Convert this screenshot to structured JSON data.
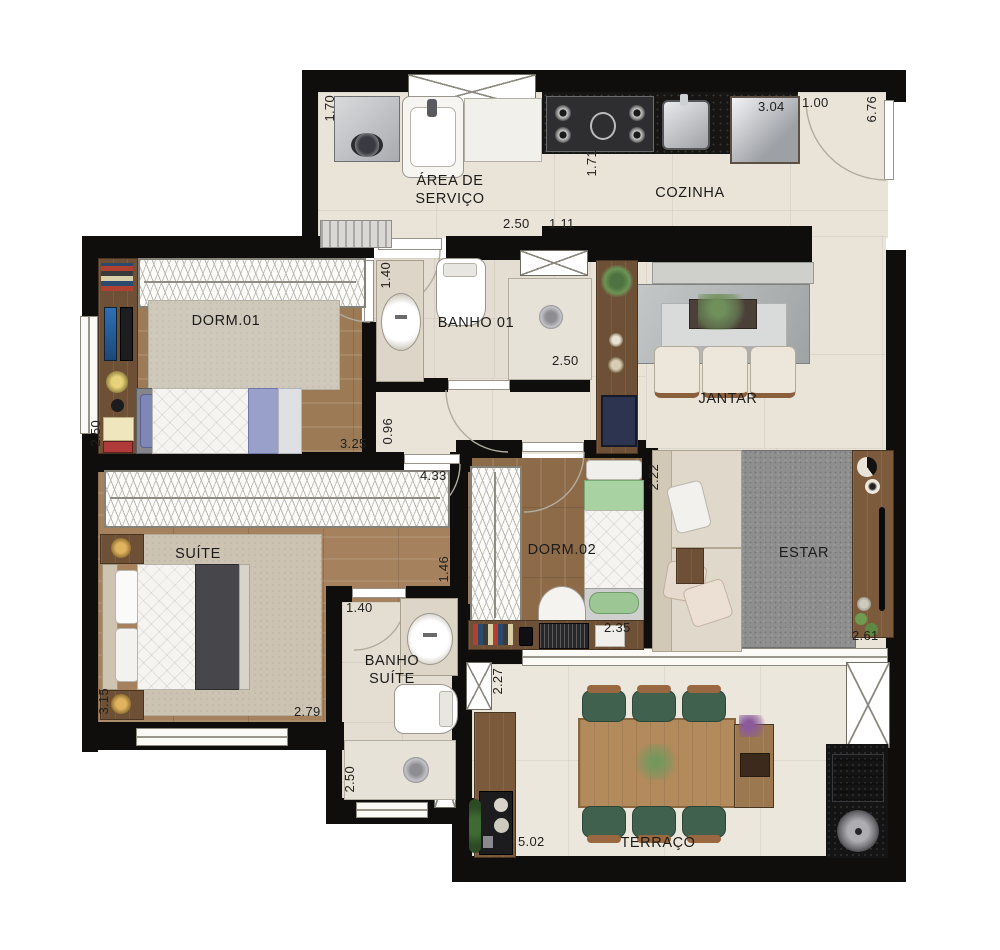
{
  "plan": {
    "type": "apartment-floor-plan",
    "style": "rendered-top-view",
    "units": "meters"
  },
  "rooms": [
    {
      "id": "area-de-servico",
      "label": "ÁREA DE SERVIÇO"
    },
    {
      "id": "cozinha",
      "label": "COZINHA"
    },
    {
      "id": "banho-01",
      "label": "BANHO 01"
    },
    {
      "id": "dorm-01",
      "label": "DORM.01"
    },
    {
      "id": "jantar",
      "label": "JANTAR"
    },
    {
      "id": "suite",
      "label": "SUÍTE"
    },
    {
      "id": "dorm-02",
      "label": "DORM.02"
    },
    {
      "id": "estar",
      "label": "ESTAR"
    },
    {
      "id": "banho-suite",
      "label": "BANHO SUÍTE"
    },
    {
      "id": "terraco",
      "label": "TERRAÇO"
    }
  ],
  "dimensions": [
    {
      "text": "1.70",
      "room": "area-de-servico",
      "orientation": "vertical"
    },
    {
      "text": "2.50",
      "room": "area-de-servico",
      "orientation": "horizontal"
    },
    {
      "text": "1.11",
      "room": "cozinha",
      "orientation": "horizontal"
    },
    {
      "text": "1.71",
      "room": "cozinha",
      "orientation": "vertical"
    },
    {
      "text": "3.04",
      "room": "cozinha",
      "orientation": "horizontal"
    },
    {
      "text": "1.00",
      "room": "cozinha",
      "orientation": "horizontal"
    },
    {
      "text": "6.76",
      "room": "entry",
      "orientation": "vertical"
    },
    {
      "text": "1.40",
      "room": "banho-01",
      "orientation": "vertical"
    },
    {
      "text": "2.50",
      "room": "banho-01",
      "orientation": "horizontal"
    },
    {
      "text": "2.50",
      "room": "dorm-01",
      "orientation": "vertical"
    },
    {
      "text": "3.25",
      "room": "dorm-01",
      "orientation": "horizontal"
    },
    {
      "text": "0.96",
      "room": "hall",
      "orientation": "vertical"
    },
    {
      "text": "4.33",
      "room": "suite",
      "orientation": "horizontal"
    },
    {
      "text": "1.46",
      "room": "suite",
      "orientation": "vertical"
    },
    {
      "text": "2.22",
      "room": "dorm-02",
      "orientation": "vertical"
    },
    {
      "text": "2.35",
      "room": "dorm-02",
      "orientation": "horizontal"
    },
    {
      "text": "2.61",
      "room": "estar",
      "orientation": "horizontal"
    },
    {
      "text": "1.40",
      "room": "banho-suite",
      "orientation": "horizontal"
    },
    {
      "text": "2.50",
      "room": "banho-suite",
      "orientation": "vertical"
    },
    {
      "text": "3.15",
      "room": "suite",
      "orientation": "vertical"
    },
    {
      "text": "2.79",
      "room": "suite",
      "orientation": "horizontal"
    },
    {
      "text": "2.27",
      "room": "terraco",
      "orientation": "vertical"
    },
    {
      "text": "5.02",
      "room": "terraco",
      "orientation": "horizontal"
    }
  ],
  "colors": {
    "wall": "#0f0e0c",
    "tile_floor": "#e9e3d8",
    "wood_floor": "#9d7a56",
    "counter_granite": "#161513",
    "estar_rug": "#8f8f8f",
    "terrace_chair_green": "#40614e",
    "suite_blanket": "#47474b",
    "dorm01_accent": "#9aa0cc",
    "dorm02_accent": "#a9d2a2"
  }
}
